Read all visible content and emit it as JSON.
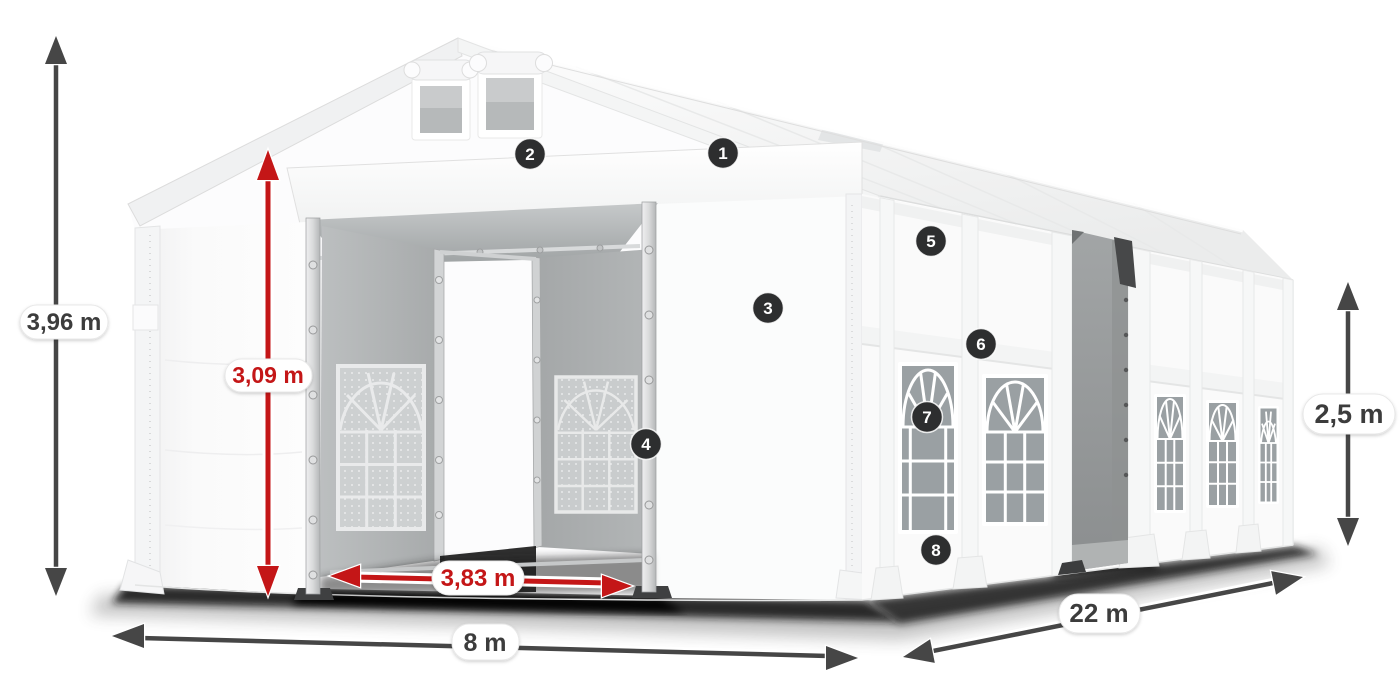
{
  "illustration": {
    "badges": [
      {
        "number": "1"
      },
      {
        "number": "2"
      },
      {
        "number": "3"
      },
      {
        "number": "4"
      },
      {
        "number": "5"
      },
      {
        "number": "6"
      },
      {
        "number": "7"
      },
      {
        "number": "8"
      }
    ],
    "dimensions": {
      "total_height": {
        "value": "3,96 m",
        "style": "dark"
      },
      "inner_height": {
        "value": "3,09 m",
        "style": "red"
      },
      "door_width": {
        "value": "3,83 m",
        "style": "red"
      },
      "front_width": {
        "value": "8 m",
        "style": "dark"
      },
      "side_length": {
        "value": "22 m",
        "style": "dark"
      },
      "side_height": {
        "value": "2,5 m",
        "style": "dark"
      }
    },
    "colors": {
      "accent_red": "#c41617",
      "arrow_dark": "#464646",
      "badge_background": "#2d2e2f",
      "label_text_dark": "#3c3c3c",
      "pill_background": "#ffffff"
    }
  }
}
